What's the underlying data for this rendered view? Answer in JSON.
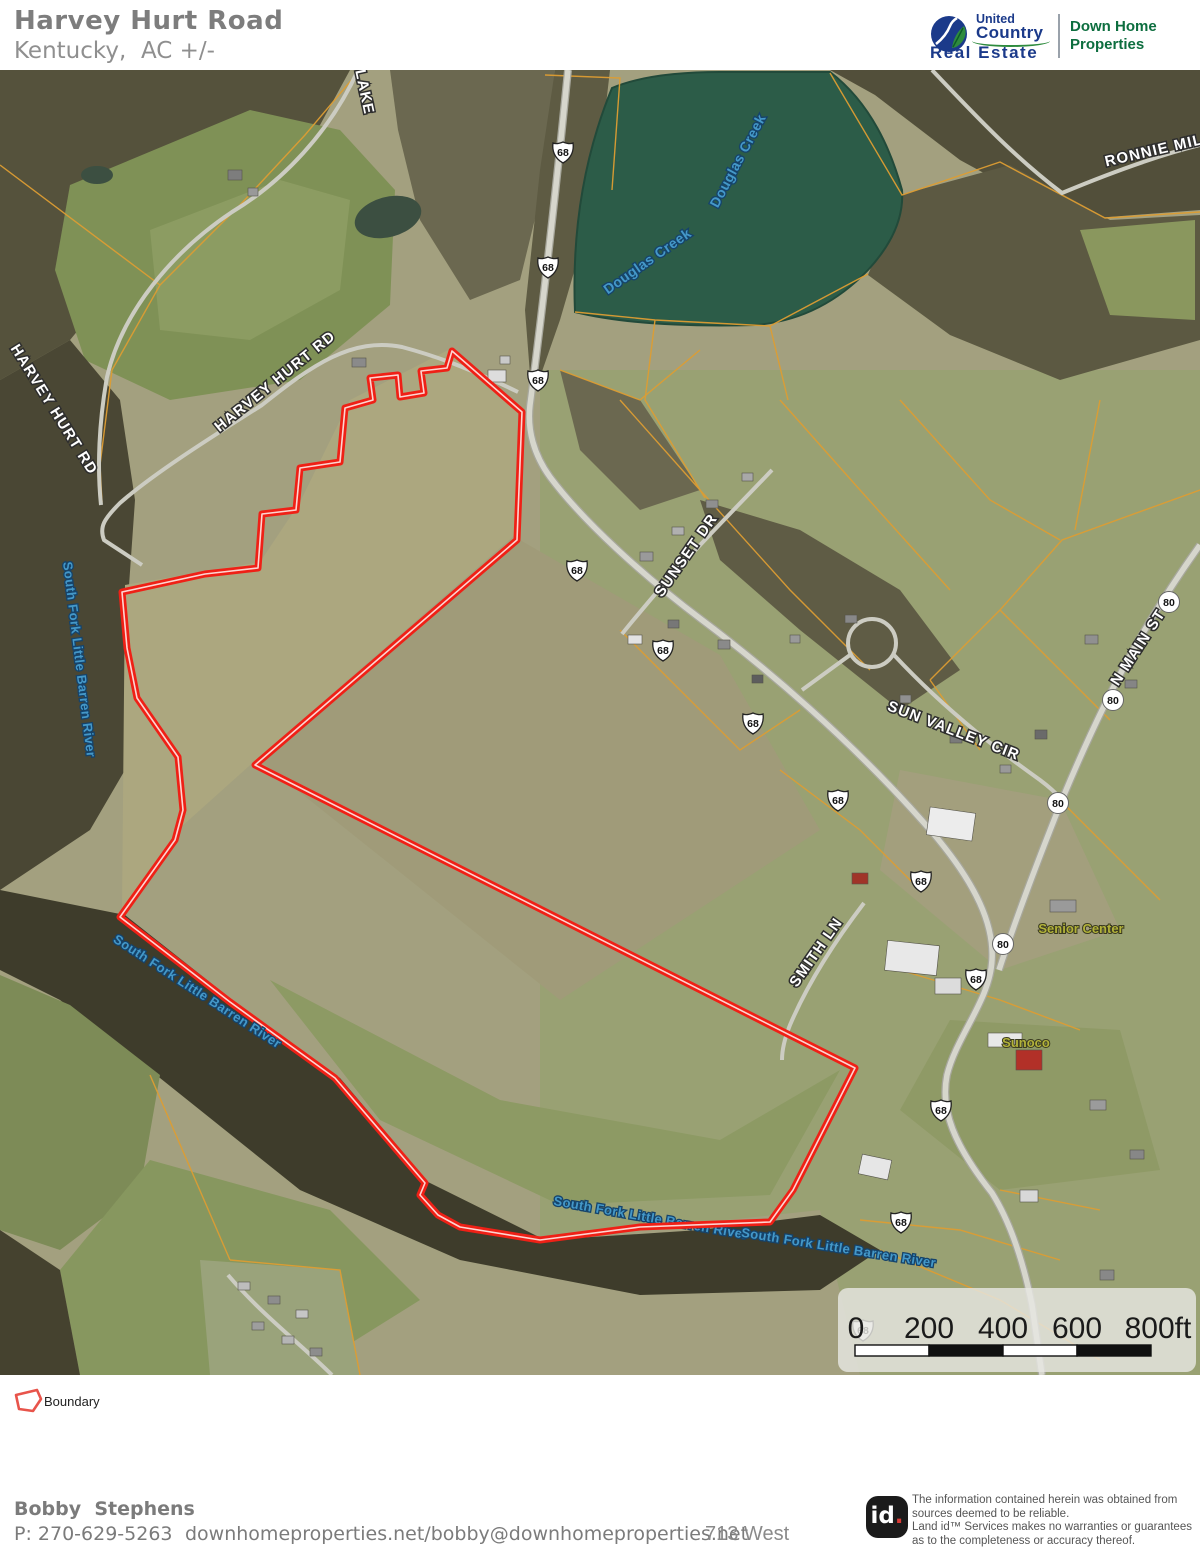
{
  "header": {
    "title": "Harvey Hurt Road",
    "subtitle": "Kentucky,  AC +/-",
    "brand": {
      "united": "United",
      "country": "Country",
      "real_estate": "Real Estate",
      "office_line1": "Down Home",
      "office_line2": "Properties"
    }
  },
  "map": {
    "roads": {
      "harvey_hurt_rd": "HARVEY HURT RD",
      "lake": "LAKE",
      "ronnie_mill": "RONNIE MILL",
      "sunset_dr": "SUNSET DR",
      "sun_valley_cir": "SUN VALLEY CIR",
      "n_main_st": "N MAIN ST",
      "smith_ln": "SMITH LN"
    },
    "route_68": "68",
    "route_80": "80",
    "water": {
      "douglas_creek": "Douglas Creek",
      "river": "South Fork Little Barren River"
    },
    "pois": {
      "senior_center": "Senior Center",
      "sunoco": "Sunoco"
    },
    "scalebar": {
      "t0": "0",
      "t200": "200",
      "t400": "400",
      "t600": "600",
      "t800": "800ft"
    }
  },
  "legend": {
    "boundary": "Boundary"
  },
  "footer": {
    "agent": "Bobby  Stephens",
    "phone": "P: 270-629-5263",
    "web": "downhomeproperties.net/bobby@downhomeproperties.net",
    "address": "713 West",
    "logo_id": "id",
    "logo_dot": ".",
    "disclaimer_l1": "The information contained herein was obtained from",
    "disclaimer_l2": "sources deemed to be reliable.",
    "disclaimer_l3": " Land id™ Services makes no warranties or guarantees",
    "disclaimer_l4": "as to the completeness or accuracy thereof."
  },
  "colors": {
    "boundary_red": "#ef2016",
    "parcel_orange": "#dd9d33",
    "brand_blue": "#1b3a8a",
    "brand_green": "#0d6e3f",
    "water_blue": "#4498c8"
  }
}
